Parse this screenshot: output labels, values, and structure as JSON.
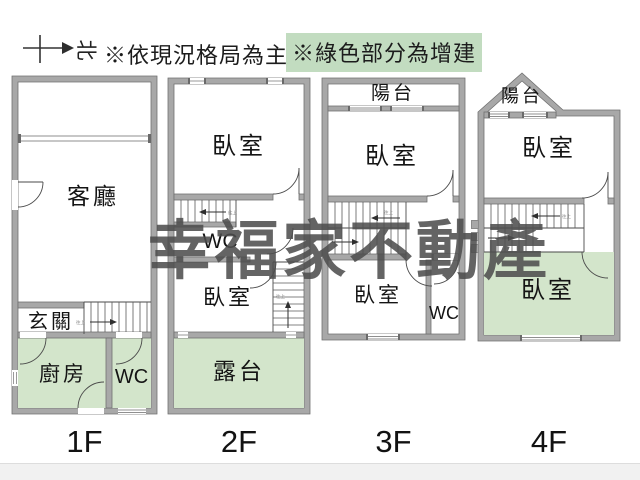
{
  "header": {
    "compass": {
      "north_label": "北"
    },
    "note_primary": "※依現況格局為主",
    "note_addition": "※綠色部分為增建"
  },
  "watermark": "幸福家不動產",
  "stairs_note": "往上",
  "colors": {
    "wall_fill": "#a8a8a8",
    "wall_stroke": "#707070",
    "addition_green": "#d3e5cb",
    "note_highlight": "#c2dcc0",
    "watermark_color": "#4e4e4e"
  },
  "floors": [
    {
      "label": "1F",
      "rooms": [
        {
          "key": "living-room",
          "label": "客廳",
          "addition": false
        },
        {
          "key": "entry",
          "label": "玄關",
          "addition": false
        },
        {
          "key": "kitchen",
          "label": "廚房",
          "addition": true
        },
        {
          "key": "wc",
          "label": "WC",
          "addition": true
        }
      ]
    },
    {
      "label": "2F",
      "rooms": [
        {
          "key": "bedroom-upper",
          "label": "臥室",
          "addition": false
        },
        {
          "key": "wc",
          "label": "WC",
          "addition": false
        },
        {
          "key": "bedroom-lower",
          "label": "臥室",
          "addition": false
        },
        {
          "key": "terrace",
          "label": "露台",
          "addition": true
        }
      ]
    },
    {
      "label": "3F",
      "rooms": [
        {
          "key": "balcony",
          "label": "陽台",
          "addition": false
        },
        {
          "key": "bedroom-upper",
          "label": "臥室",
          "addition": false
        },
        {
          "key": "bedroom-lower",
          "label": "臥室",
          "addition": false
        },
        {
          "key": "wc",
          "label": "WC",
          "addition": false
        }
      ]
    },
    {
      "label": "4F",
      "rooms": [
        {
          "key": "balcony",
          "label": "陽台",
          "addition": false
        },
        {
          "key": "bedroom-upper",
          "label": "臥室",
          "addition": false
        },
        {
          "key": "bedroom-lower",
          "label": "臥室",
          "addition": true
        }
      ]
    }
  ]
}
